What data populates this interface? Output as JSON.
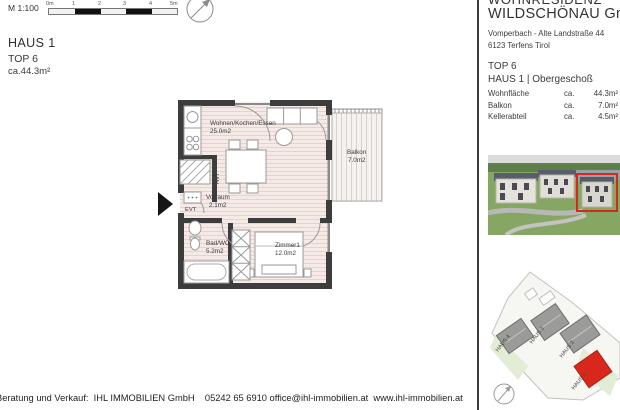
{
  "scalebar": {
    "label": "M 1:100",
    "ticks": [
      "0m",
      "1",
      "2",
      "3",
      "4",
      "5m"
    ]
  },
  "plan_title": {
    "haus": "HAUS 1",
    "top": "TOP 6",
    "area": "ca.44.3m²"
  },
  "floorplan": {
    "living_name": "Wohnen/Kochen/Essen",
    "living_area": "25.0m2",
    "vorraum_name": "Vorraum",
    "vorraum_area": "2.1m2",
    "bad_name": "Bad/WC",
    "bad_area": "5.2m2",
    "zimmer_name": "Zimmer1",
    "zimmer_area": "12.0m2",
    "balkon_name": "Balkon",
    "balkon_area": "7.0m2",
    "evt": "EVT",
    "hvt": "HVT"
  },
  "info_panel": {
    "company_line1": "WOHNRESIDENZ",
    "company_line2": "WILDSCHÖNAU GmbH",
    "address_line1": "Vomperbach - Alte Landstraße 44",
    "address_line2": "6123 Terfens Tirol",
    "unit": "TOP 6",
    "unit_floor": "HAUS 1 | Obergeschoß",
    "rows": [
      {
        "label": "Wohnfläche",
        "ca": "ca.",
        "value": "44.3m²"
      },
      {
        "label": "Balkon",
        "ca": "ca.",
        "value": "7.0m²"
      },
      {
        "label": "Kellerabteil",
        "ca": "ca.",
        "value": "4.5m²"
      }
    ]
  },
  "siteplan": {
    "haus1": "HAUS 1",
    "haus2": "HAUS 2",
    "haus3": "HAUS 3",
    "haus4": "HAUS 4"
  },
  "footer": {
    "text": "Beratung und Verkauf:  IHL IMMOBILIEN GmbH    05242 65 6910 office@ihl-immobilien.at  www.ihl-immobilien.at"
  },
  "colors": {
    "highlight_red": "#d6281c",
    "wall_dark": "#3d3d3d",
    "floor_pink": "#f3e5e1"
  }
}
